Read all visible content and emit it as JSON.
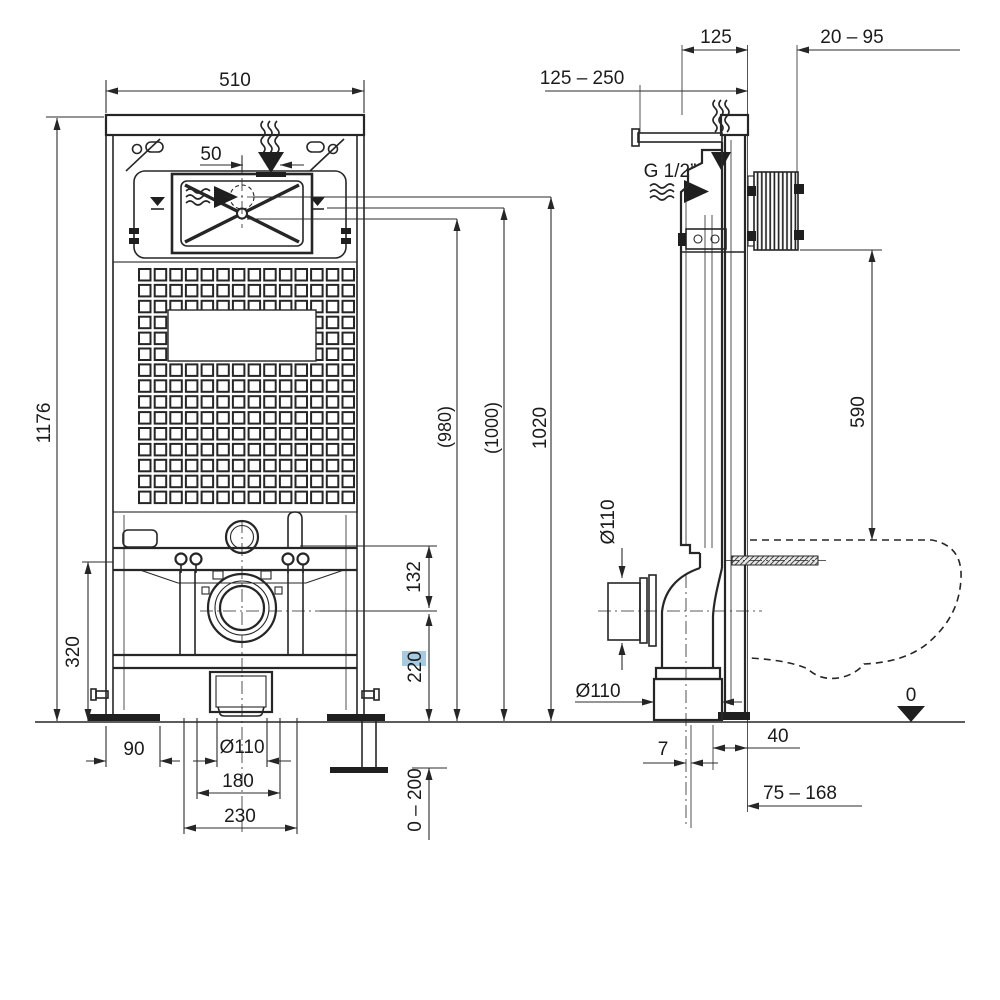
{
  "front": {
    "overall_width": "510",
    "inlet_offset": "50",
    "frame_height": "1176",
    "bracket_height": "320",
    "foot_plate_width": "90",
    "drain_diameter": "Ø110",
    "drain_spacing": "180",
    "fixing_spacing": "230",
    "bracket_to_outlet": "132",
    "outlet_center_height": "220",
    "leg_adjustment_range": "0 – 200",
    "height_option_1": "(980)",
    "height_option_2": "(1000)",
    "overall_install_height": "1020"
  },
  "side": {
    "supply_rod_range": "125 – 250",
    "frame_depth": "125",
    "plate_clearance_range": "20 – 95",
    "water_supply_thread": "G 1/2”",
    "plate_to_bowl_height": "590",
    "outlet_pipe_diameter": "Ø110",
    "floor_outlet_diameter": "Ø110",
    "center_offset": "7",
    "outlet_to_wall": "40",
    "outlet_depth_range": "75 – 168",
    "floor_datum": "0"
  },
  "highlight": {
    "target_dimension": "220",
    "color": "#a6cbe0"
  },
  "colors": {
    "line": "#262626",
    "background": "#ffffff"
  }
}
